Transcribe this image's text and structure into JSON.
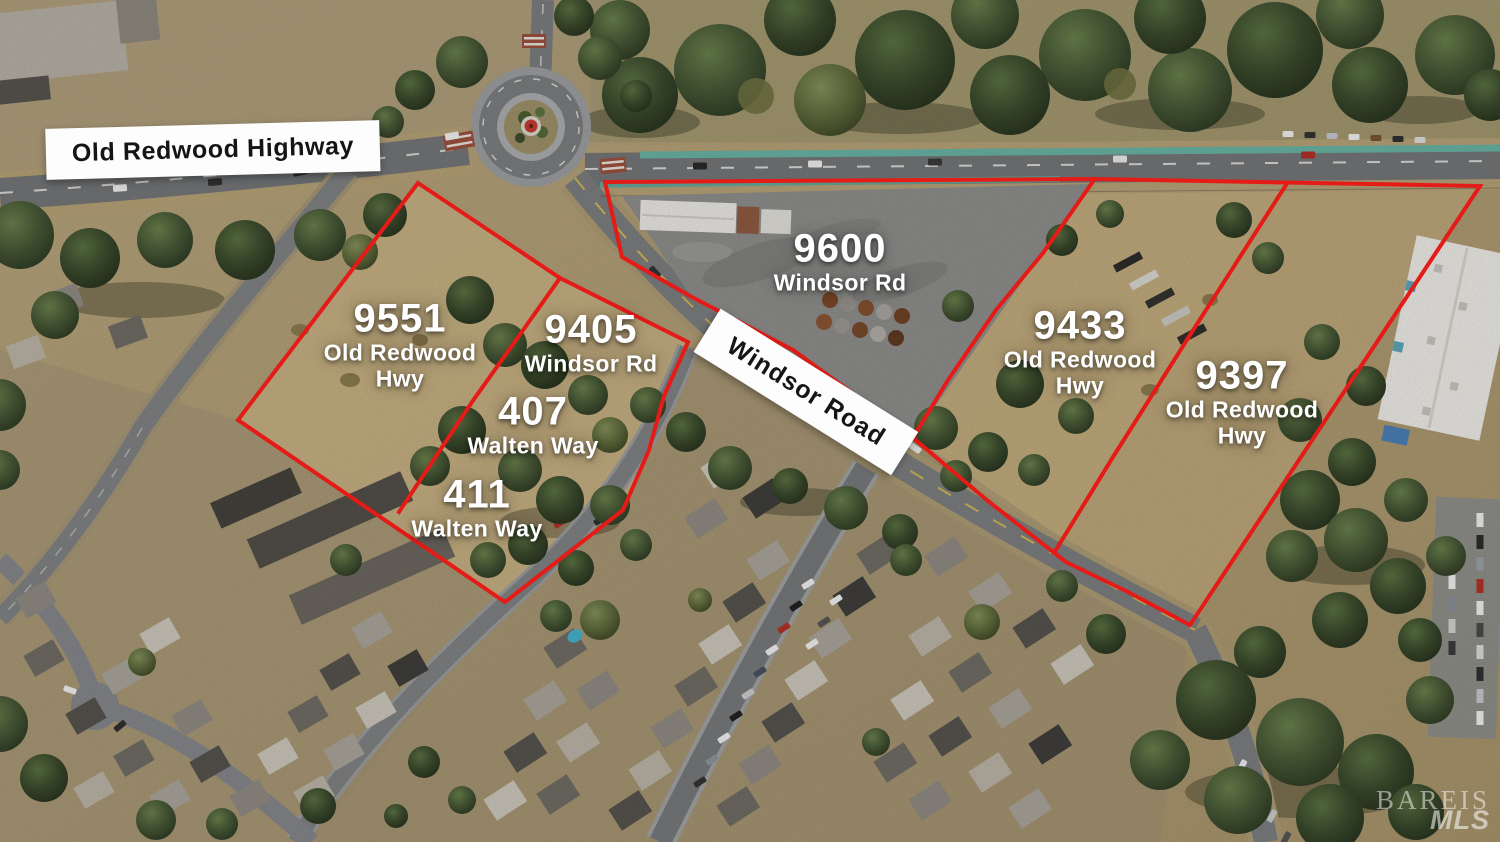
{
  "meta": {
    "description": "Aerial drone photo of property listing with outlined parcels",
    "boundary_color": "#e41b17",
    "parcel_label_color": "#ffffff",
    "road_label_bg": "#fdfdfd",
    "road_label_text_color": "#151515"
  },
  "road_labels": [
    {
      "id": "old-redwood-highway",
      "text": "Old Redwood Highway"
    },
    {
      "id": "windsor-road",
      "text": "Windsor Road"
    }
  ],
  "parcels": [
    {
      "id": "9551",
      "line1": "9551",
      "line2": "Old Redwood",
      "line3": "Hwy"
    },
    {
      "id": "9405",
      "line1": "9405",
      "line2": "Windsor Rd"
    },
    {
      "id": "407",
      "line1": "407",
      "line2": "Walten Way"
    },
    {
      "id": "411",
      "line1": "411",
      "line2": "Walten Way"
    },
    {
      "id": "9600",
      "line1": "9600",
      "line2": "Windsor Rd"
    },
    {
      "id": "9433",
      "line1": "9433",
      "line2": "Old Redwood",
      "line3": "Hwy"
    },
    {
      "id": "9397",
      "line1": "9397",
      "line2": "Old Redwood",
      "line3": "Hwy"
    }
  ],
  "watermark": {
    "line1": "BAREIS",
    "line2": "MLS"
  }
}
